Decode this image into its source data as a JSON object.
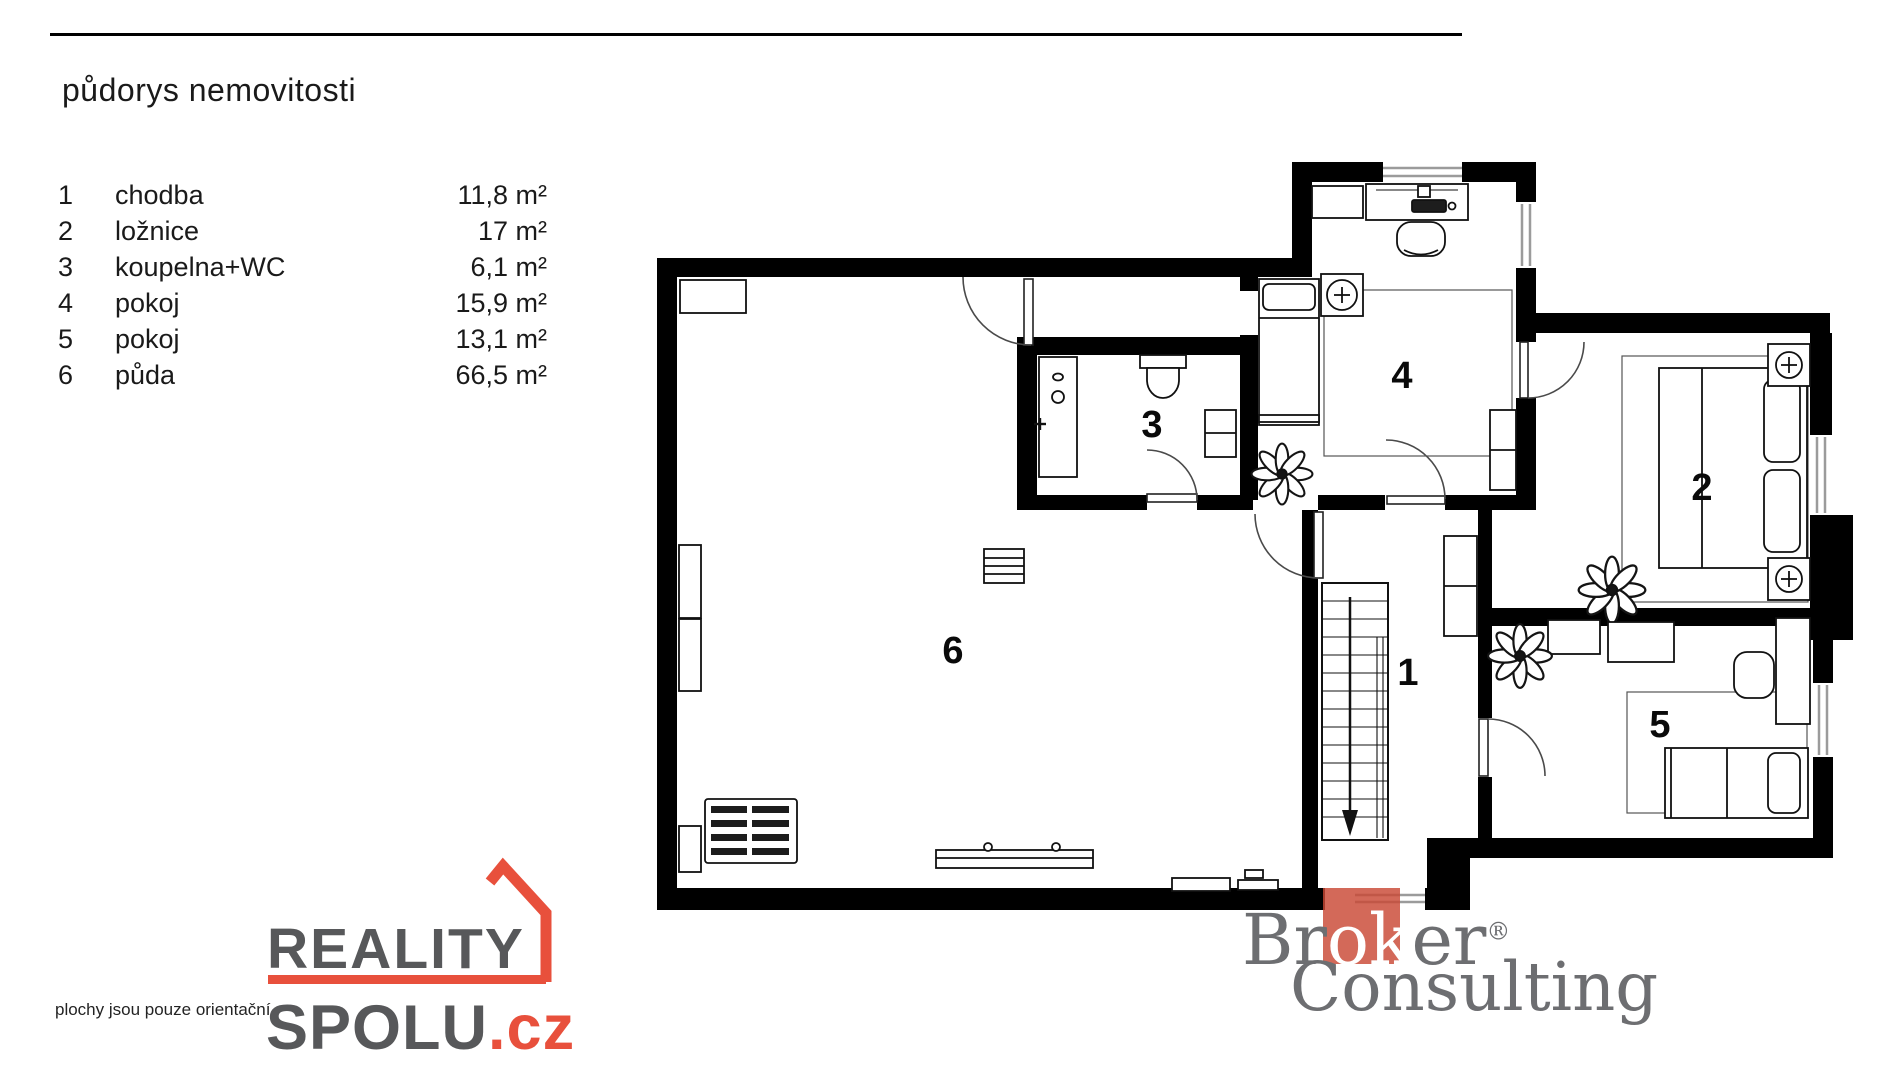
{
  "page": {
    "title": "půdorys nemovitosti"
  },
  "legend": {
    "rows": [
      {
        "num": "1",
        "name": "chodba",
        "area": "11,8 m²"
      },
      {
        "num": "2",
        "name": "ložnice",
        "area": "17 m²"
      },
      {
        "num": "3",
        "name": "koupelna+WC",
        "area": "6,1 m²"
      },
      {
        "num": "4",
        "name": "pokoj",
        "area": "15,9 m²"
      },
      {
        "num": "5",
        "name": "pokoj",
        "area": "13,1 m²"
      },
      {
        "num": "6",
        "name": "půda",
        "area": "66,5 m²"
      }
    ]
  },
  "plan": {
    "labels": [
      "1",
      "2",
      "3",
      "4",
      "5",
      "6"
    ]
  },
  "footer": {
    "disclaimer": "plochy jsou pouze orientační",
    "reality": {
      "line1": "REALITY",
      "line2": "SPOLU",
      "tld": ".cz"
    },
    "broker": {
      "p1": "Br",
      "p2": "ok",
      "p3": "er",
      "reg": "®",
      "line2": "Consulting"
    }
  },
  "colors": {
    "reality_red": "#e8503c",
    "reality_gray": "#57585a",
    "broker_gray": "#6d6e71",
    "broker_red": "#c94835",
    "wall_black": "#000000",
    "window_gray": "#9b9b9b"
  }
}
